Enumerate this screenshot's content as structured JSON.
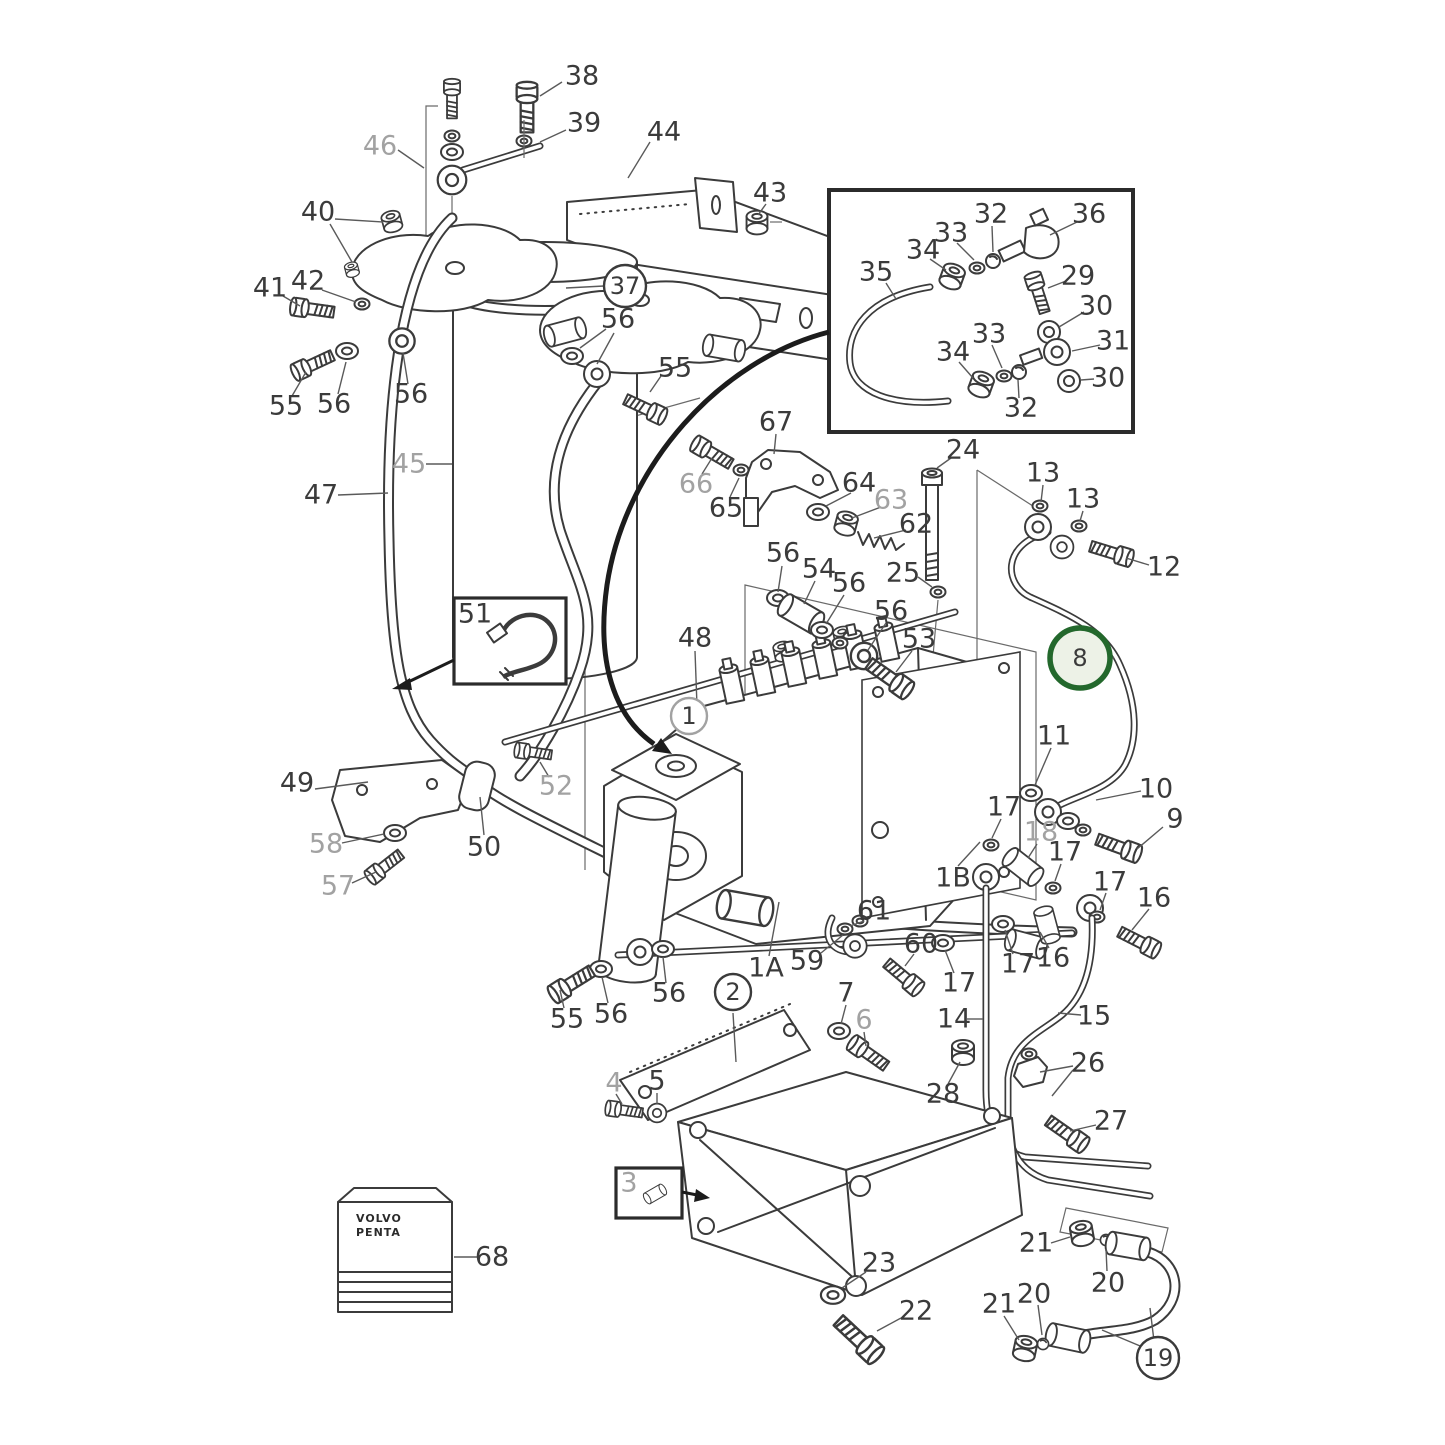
{
  "diagram": {
    "type": "exploded-parts-diagram",
    "description": "Fuel system exploded parts diagram with numbered callouts",
    "brand_text": {
      "line1": "VOLVO",
      "line2": "PENTA"
    },
    "highlighted_part": "8",
    "colors": {
      "line": "#3b3b3b",
      "gray_label": "#a2a2a2",
      "leader": "#5a5a5a",
      "highlight_ring": "#23682c",
      "highlight_fill": "#edf2e7",
      "background": "#ffffff",
      "box_border": "#2b2b2b"
    },
    "callouts": [
      {
        "n": "38",
        "x": 582,
        "y": 76,
        "leaders": [
          [
            562,
            82,
            540,
            96
          ]
        ]
      },
      {
        "n": "39",
        "x": 584,
        "y": 123,
        "leaders": [
          [
            566,
            130,
            540,
            142
          ]
        ]
      },
      {
        "n": "46",
        "x": 380,
        "y": 146,
        "col": "gray",
        "leaders": [
          [
            398,
            150,
            424,
            168
          ]
        ]
      },
      {
        "n": "44",
        "x": 664,
        "y": 132,
        "leaders": [
          [
            650,
            142,
            628,
            178
          ]
        ]
      },
      {
        "n": "40",
        "x": 318,
        "y": 212,
        "leaders": [
          [
            335,
            219,
            383,
            222
          ],
          [
            330,
            224,
            352,
            262
          ]
        ]
      },
      {
        "n": "41",
        "x": 270,
        "y": 288,
        "leaders": [
          [
            283,
            296,
            300,
            306
          ]
        ]
      },
      {
        "n": "42",
        "x": 308,
        "y": 281,
        "leaders": [
          [
            322,
            290,
            356,
            302
          ]
        ]
      },
      {
        "n": "37",
        "x": 625,
        "y": 286,
        "circ": "dark",
        "leaders": [
          [
            604,
            286,
            566,
            288
          ]
        ]
      },
      {
        "n": "56",
        "x": 618,
        "y": 319,
        "leaders": [
          [
            606,
            329,
            580,
            348
          ],
          [
            614,
            333,
            597,
            364
          ]
        ]
      },
      {
        "n": "55",
        "x": 675,
        "y": 368,
        "leaders": [
          [
            661,
            376,
            650,
            392
          ]
        ]
      },
      {
        "n": "43",
        "x": 770,
        "y": 193,
        "leaders": [
          [
            766,
            204,
            758,
            215
          ]
        ]
      },
      {
        "n": "55",
        "x": 286,
        "y": 406,
        "leaders": [
          [
            292,
            396,
            306,
            372
          ]
        ]
      },
      {
        "n": "56",
        "x": 334,
        "y": 404,
        "leaders": [
          [
            338,
            394,
            346,
            362
          ]
        ]
      },
      {
        "n": "56",
        "x": 411,
        "y": 394,
        "leaders": [
          [
            408,
            384,
            403,
            353
          ]
        ]
      },
      {
        "n": "45",
        "x": 409,
        "y": 464,
        "col": "gray",
        "leaders": [
          [
            426,
            464,
            452,
            464
          ]
        ]
      },
      {
        "n": "47",
        "x": 321,
        "y": 495,
        "leaders": [
          [
            338,
            495,
            388,
            493
          ]
        ]
      },
      {
        "n": "49",
        "x": 297,
        "y": 783,
        "leaders": [
          [
            315,
            789,
            368,
            782
          ]
        ]
      },
      {
        "n": "58",
        "x": 326,
        "y": 844,
        "col": "gray",
        "leaders": [
          [
            342,
            843,
            384,
            834
          ]
        ]
      },
      {
        "n": "57",
        "x": 338,
        "y": 886,
        "col": "gray",
        "leaders": [
          [
            352,
            883,
            376,
            872
          ]
        ]
      },
      {
        "n": "50",
        "x": 484,
        "y": 847,
        "leaders": [
          [
            484,
            835,
            480,
            797
          ]
        ]
      },
      {
        "n": "52",
        "x": 556,
        "y": 786,
        "col": "gray",
        "leaders": [
          [
            549,
            777,
            540,
            762
          ]
        ]
      },
      {
        "n": "68",
        "x": 492,
        "y": 1257,
        "leaders": [
          [
            477,
            1257,
            454,
            1257
          ]
        ]
      },
      {
        "n": "51",
        "x": 475,
        "y": 614
      },
      {
        "n": "48",
        "x": 695,
        "y": 638,
        "leaders": [
          [
            695,
            651,
            697,
            706
          ]
        ]
      },
      {
        "n": "1",
        "x": 689,
        "y": 716,
        "circ": "gray"
      },
      {
        "n": "56",
        "x": 783,
        "y": 553,
        "leaders": [
          [
            782,
            566,
            778,
            592
          ]
        ]
      },
      {
        "n": "54",
        "x": 819,
        "y": 569,
        "leaders": [
          [
            815,
            581,
            804,
            604
          ]
        ]
      },
      {
        "n": "56",
        "x": 849,
        "y": 583,
        "leaders": [
          [
            844,
            595,
            826,
            624
          ]
        ]
      },
      {
        "n": "25",
        "x": 903,
        "y": 573,
        "leaders": [
          [
            918,
            577,
            932,
            587
          ]
        ]
      },
      {
        "n": "24",
        "x": 963,
        "y": 450,
        "leaders": [
          [
            951,
            458,
            937,
            468
          ]
        ]
      },
      {
        "n": "56",
        "x": 891,
        "y": 611,
        "leaders": [
          [
            886,
            623,
            868,
            650
          ]
        ]
      },
      {
        "n": "53",
        "x": 919,
        "y": 639,
        "leaders": [
          [
            912,
            651,
            896,
            672
          ]
        ]
      },
      {
        "n": "67",
        "x": 776,
        "y": 422,
        "leaders": [
          [
            776,
            434,
            774,
            454
          ]
        ]
      },
      {
        "n": "66",
        "x": 696,
        "y": 484,
        "col": "gray",
        "leaders": [
          [
            702,
            474,
            712,
            458
          ]
        ]
      },
      {
        "n": "65",
        "x": 726,
        "y": 508,
        "leaders": [
          [
            730,
            497,
            739,
            478
          ]
        ]
      },
      {
        "n": "64",
        "x": 859,
        "y": 483,
        "leaders": [
          [
            851,
            493,
            826,
            506
          ]
        ]
      },
      {
        "n": "63",
        "x": 891,
        "y": 500,
        "col": "gray",
        "leaders": [
          [
            881,
            507,
            852,
            518
          ]
        ]
      },
      {
        "n": "62",
        "x": 916,
        "y": 524,
        "leaders": [
          [
            906,
            530,
            874,
            538
          ]
        ]
      },
      {
        "n": "1B",
        "x": 953,
        "y": 878,
        "leaders": [
          [
            958,
            866,
            980,
            842
          ]
        ]
      },
      {
        "n": "13",
        "x": 1043,
        "y": 473,
        "leaders": [
          [
            1043,
            485,
            1041,
            502
          ]
        ]
      },
      {
        "n": "13",
        "x": 1083,
        "y": 499,
        "leaders": [
          [
            1083,
            511,
            1080,
            521
          ]
        ]
      },
      {
        "n": "12",
        "x": 1164,
        "y": 567,
        "leaders": [
          [
            1149,
            565,
            1126,
            558
          ]
        ]
      },
      {
        "n": "8",
        "x": 1080,
        "y": 658,
        "circ": "green",
        "leaders": [
          [
            1096,
            656,
            1114,
            658
          ]
        ]
      },
      {
        "n": "11",
        "x": 1054,
        "y": 736,
        "leaders": [
          [
            1051,
            748,
            1035,
            785
          ]
        ]
      },
      {
        "n": "10",
        "x": 1156,
        "y": 789,
        "leaders": [
          [
            1141,
            791,
            1096,
            800
          ]
        ]
      },
      {
        "n": "9",
        "x": 1175,
        "y": 819,
        "leaders": [
          [
            1163,
            827,
            1137,
            849
          ]
        ]
      },
      {
        "n": "17",
        "x": 1004,
        "y": 807,
        "leaders": [
          [
            1001,
            819,
            992,
            838
          ]
        ]
      },
      {
        "n": "18",
        "x": 1041,
        "y": 832,
        "col": "gray",
        "leaders": [
          [
            1037,
            844,
            1028,
            858
          ]
        ]
      },
      {
        "n": "17",
        "x": 1065,
        "y": 852,
        "leaders": [
          [
            1061,
            864,
            1055,
            881
          ]
        ]
      },
      {
        "n": "16",
        "x": 1154,
        "y": 898,
        "leaders": [
          [
            1149,
            909,
            1132,
            930
          ]
        ]
      },
      {
        "n": "17",
        "x": 1110,
        "y": 882,
        "leaders": [
          [
            1106,
            893,
            1100,
            910
          ]
        ]
      },
      {
        "n": "16",
        "x": 1053,
        "y": 958,
        "leaders": [
          [
            1049,
            948,
            1040,
            932
          ]
        ]
      },
      {
        "n": "17",
        "x": 1018,
        "y": 964,
        "leaders": [
          [
            1013,
            954,
            1005,
            930
          ]
        ]
      },
      {
        "n": "17",
        "x": 959,
        "y": 983,
        "leaders": [
          [
            954,
            973,
            945,
            950
          ]
        ]
      },
      {
        "n": "59",
        "x": 807,
        "y": 961,
        "leaders": [
          [
            821,
            953,
            843,
            935
          ]
        ]
      },
      {
        "n": "1A",
        "x": 766,
        "y": 968,
        "leaders": [
          [
            769,
            956,
            779,
            902
          ]
        ]
      },
      {
        "n": "61",
        "x": 874,
        "y": 911,
        "leaders": [
          [
            864,
            921,
            850,
            926
          ]
        ]
      },
      {
        "n": "60",
        "x": 921,
        "y": 944,
        "leaders": [
          [
            914,
            954,
            905,
            966
          ]
        ]
      },
      {
        "n": "14",
        "x": 954,
        "y": 1019,
        "leaders": [
          [
            967,
            1019,
            983,
            1019
          ]
        ]
      },
      {
        "n": "15",
        "x": 1094,
        "y": 1016,
        "leaders": [
          [
            1081,
            1015,
            1058,
            1013
          ]
        ]
      },
      {
        "n": "26",
        "x": 1088,
        "y": 1063,
        "leaders": [
          [
            1073,
            1066,
            1040,
            1072
          ],
          [
            1073,
            1070,
            1052,
            1096
          ]
        ]
      },
      {
        "n": "28",
        "x": 943,
        "y": 1094,
        "leaders": [
          [
            948,
            1084,
            960,
            1062
          ]
        ]
      },
      {
        "n": "27",
        "x": 1111,
        "y": 1121,
        "leaders": [
          [
            1096,
            1125,
            1070,
            1131
          ]
        ]
      },
      {
        "n": "7",
        "x": 846,
        "y": 993,
        "leaders": [
          [
            846,
            1005,
            841,
            1024
          ]
        ]
      },
      {
        "n": "6",
        "x": 864,
        "y": 1020,
        "col": "gray",
        "leaders": [
          [
            864,
            1032,
            866,
            1046
          ]
        ]
      },
      {
        "n": "2",
        "x": 733,
        "y": 992,
        "circ": "dark",
        "leaders": [
          [
            733,
            1013,
            736,
            1062
          ]
        ]
      },
      {
        "n": "4",
        "x": 614,
        "y": 1083,
        "col": "gray",
        "leaders": [
          [
            616,
            1094,
            622,
            1104
          ]
        ]
      },
      {
        "n": "5",
        "x": 657,
        "y": 1081,
        "leaders": [
          [
            657,
            1093,
            657,
            1104
          ]
        ]
      },
      {
        "n": "23",
        "x": 879,
        "y": 1263,
        "leaders": [
          [
            866,
            1272,
            842,
            1288
          ]
        ]
      },
      {
        "n": "22",
        "x": 916,
        "y": 1311,
        "leaders": [
          [
            901,
            1318,
            877,
            1331
          ]
        ]
      },
      {
        "n": "21",
        "x": 1036,
        "y": 1243,
        "leaders": [
          [
            1051,
            1243,
            1070,
            1237
          ]
        ]
      },
      {
        "n": "20",
        "x": 1108,
        "y": 1283,
        "leaders": [
          [
            1107,
            1271,
            1106,
            1249
          ]
        ]
      },
      {
        "n": "20",
        "x": 1034,
        "y": 1294,
        "leaders": [
          [
            1038,
            1305,
            1042,
            1335
          ]
        ]
      },
      {
        "n": "21",
        "x": 999,
        "y": 1304,
        "leaders": [
          [
            1004,
            1316,
            1019,
            1340
          ]
        ]
      },
      {
        "n": "19",
        "x": 1158,
        "y": 1358,
        "circ": "dark",
        "leaders": [
          [
            1154,
            1341,
            1150,
            1308
          ],
          [
            1145,
            1348,
            1102,
            1330
          ]
        ]
      },
      {
        "n": "55",
        "x": 567,
        "y": 1019,
        "leaders": [
          [
            564,
            1008,
            560,
            990
          ]
        ]
      },
      {
        "n": "56",
        "x": 611,
        "y": 1014,
        "leaders": [
          [
            608,
            1003,
            602,
            977
          ]
        ]
      },
      {
        "n": "56",
        "x": 669,
        "y": 993,
        "leaders": [
          [
            666,
            983,
            663,
            957
          ]
        ]
      },
      {
        "n": "35",
        "x": 876,
        "y": 272,
        "leaders": [
          [
            886,
            283,
            896,
            299
          ]
        ]
      },
      {
        "n": "34",
        "x": 923,
        "y": 250,
        "leaders": [
          [
            930,
            259,
            946,
            270
          ]
        ]
      },
      {
        "n": "33",
        "x": 951,
        "y": 233,
        "leaders": [
          [
            957,
            243,
            974,
            260
          ]
        ]
      },
      {
        "n": "32",
        "x": 991,
        "y": 214,
        "leaders": [
          [
            992,
            226,
            993,
            252
          ]
        ]
      },
      {
        "n": "36",
        "x": 1089,
        "y": 214,
        "leaders": [
          [
            1077,
            222,
            1050,
            235
          ]
        ]
      },
      {
        "n": "29",
        "x": 1078,
        "y": 276,
        "leaders": [
          [
            1066,
            281,
            1048,
            288
          ]
        ]
      },
      {
        "n": "30",
        "x": 1096,
        "y": 306,
        "leaders": [
          [
            1084,
            312,
            1059,
            327
          ]
        ]
      },
      {
        "n": "31",
        "x": 1113,
        "y": 341,
        "leaders": [
          [
            1100,
            345,
            1072,
            351
          ]
        ]
      },
      {
        "n": "30",
        "x": 1108,
        "y": 378,
        "leaders": [
          [
            1094,
            379,
            1081,
            380
          ]
        ]
      },
      {
        "n": "32",
        "x": 1021,
        "y": 408,
        "leaders": [
          [
            1019,
            398,
            1018,
            380
          ]
        ]
      },
      {
        "n": "33",
        "x": 989,
        "y": 334,
        "leaders": [
          [
            992,
            345,
            1002,
            368
          ]
        ]
      },
      {
        "n": "34",
        "x": 953,
        "y": 352,
        "leaders": [
          [
            959,
            362,
            973,
            378
          ]
        ]
      },
      {
        "n": "3",
        "x": 629,
        "y": 1183,
        "col": "gray"
      }
    ]
  }
}
